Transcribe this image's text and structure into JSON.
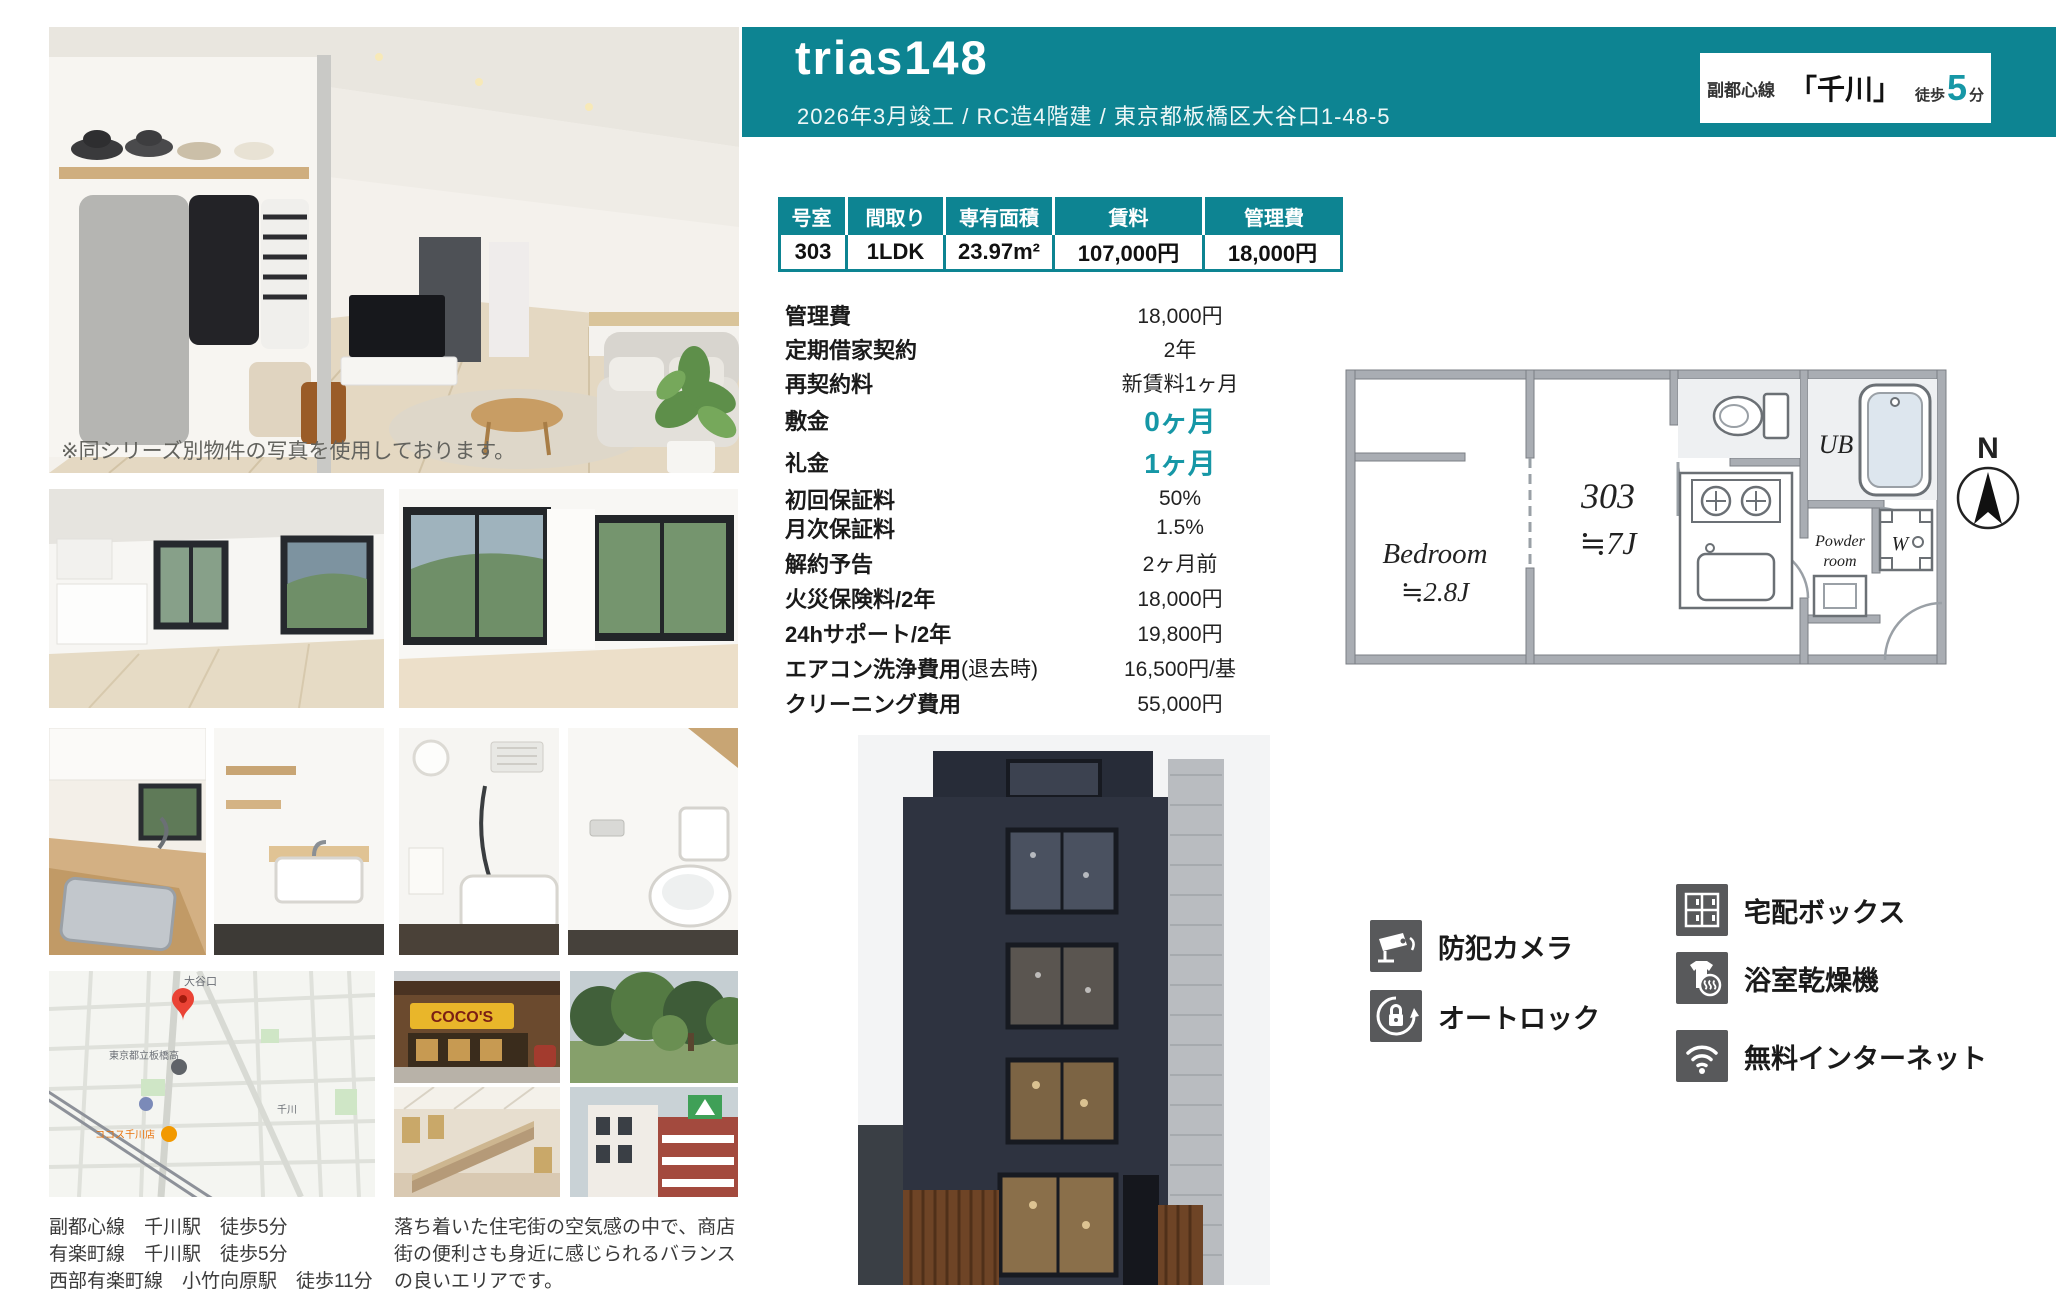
{
  "header": {
    "title": "trias148",
    "subtitle": "2026年3月竣工 / RC造4階建 / 東京都板橋区大谷口1-48-5",
    "station_box": {
      "line": "副都心線",
      "station": "「千川」",
      "walk_prefix": "徒歩",
      "walk_minutes": "5",
      "walk_suffix": "分"
    }
  },
  "colors": {
    "teal": "#0d8492",
    "teal_accent": "#1697a6",
    "icon_gray": "#58595b"
  },
  "photo_caption": "※同シリーズ別物件の写真を使用しております。",
  "unit_table": {
    "headers": [
      "号室",
      "間取り",
      "専有面積",
      "賃料",
      "管理費"
    ],
    "values": [
      "303",
      "1LDK",
      "23.97m²",
      "107,000円",
      "18,000円"
    ]
  },
  "details": {
    "rows": [
      {
        "label": "管理費",
        "value": "18,000円"
      },
      {
        "label": "定期借家契約",
        "value": "2年"
      },
      {
        "label": "再契約料",
        "value": "新賃料1ヶ月"
      },
      {
        "label": "敷金",
        "value": "0ヶ月"
      },
      {
        "label": "礼金",
        "value": "1ヶ月"
      },
      {
        "label": "初回保証料",
        "value": "50%"
      },
      {
        "label": "月次保証料",
        "value": "1.5%"
      },
      {
        "label": "解約予告",
        "value": "2ヶ月前"
      },
      {
        "label": "火災保険料/2年",
        "value": "18,000円"
      },
      {
        "label": "24hサポート/2年",
        "value": "19,800円"
      },
      {
        "label": "エアコン洗浄費用",
        "label_suffix": " (退去時)",
        "value": "16,500円/基"
      },
      {
        "label": "クリーニング費用",
        "value": "55,000円"
      }
    ]
  },
  "floorplan": {
    "bedroom": "Bedroom",
    "bedroom_size": "≒2.8J",
    "unit": "303",
    "unit_size": "≒7J",
    "ub": "UB",
    "powder_line1": "Powder",
    "powder_line2": "room",
    "washer": "W",
    "compass": "N"
  },
  "amenities": {
    "left": [
      {
        "icon": "security-camera-icon",
        "label": "防犯カメラ"
      },
      {
        "icon": "autolock-icon",
        "label": "オートロック"
      }
    ],
    "right": [
      {
        "icon": "delivery-box-icon",
        "label": "宅配ボックス"
      },
      {
        "icon": "bathroom-dryer-icon",
        "label": "浴室乾燥機"
      },
      {
        "icon": "wifi-icon",
        "label": "無料インターネット"
      }
    ]
  },
  "stations": [
    "副都心線　千川駅　徒歩5分",
    "有楽町線　千川駅　徒歩5分",
    "西部有楽町線　小竹向原駅　徒歩11分"
  ],
  "area_description": "落ち着いた住宅街の空気感の中で、商店街の便利さも身近に感じられるバランスの良いエリアです。",
  "map": {
    "labels": {
      "district": "大谷口",
      "school": "東京都立板橋高",
      "restaurant": "ココス千川店",
      "station": "千川"
    }
  },
  "photos": {
    "cocos_sign": "COCO'S"
  }
}
